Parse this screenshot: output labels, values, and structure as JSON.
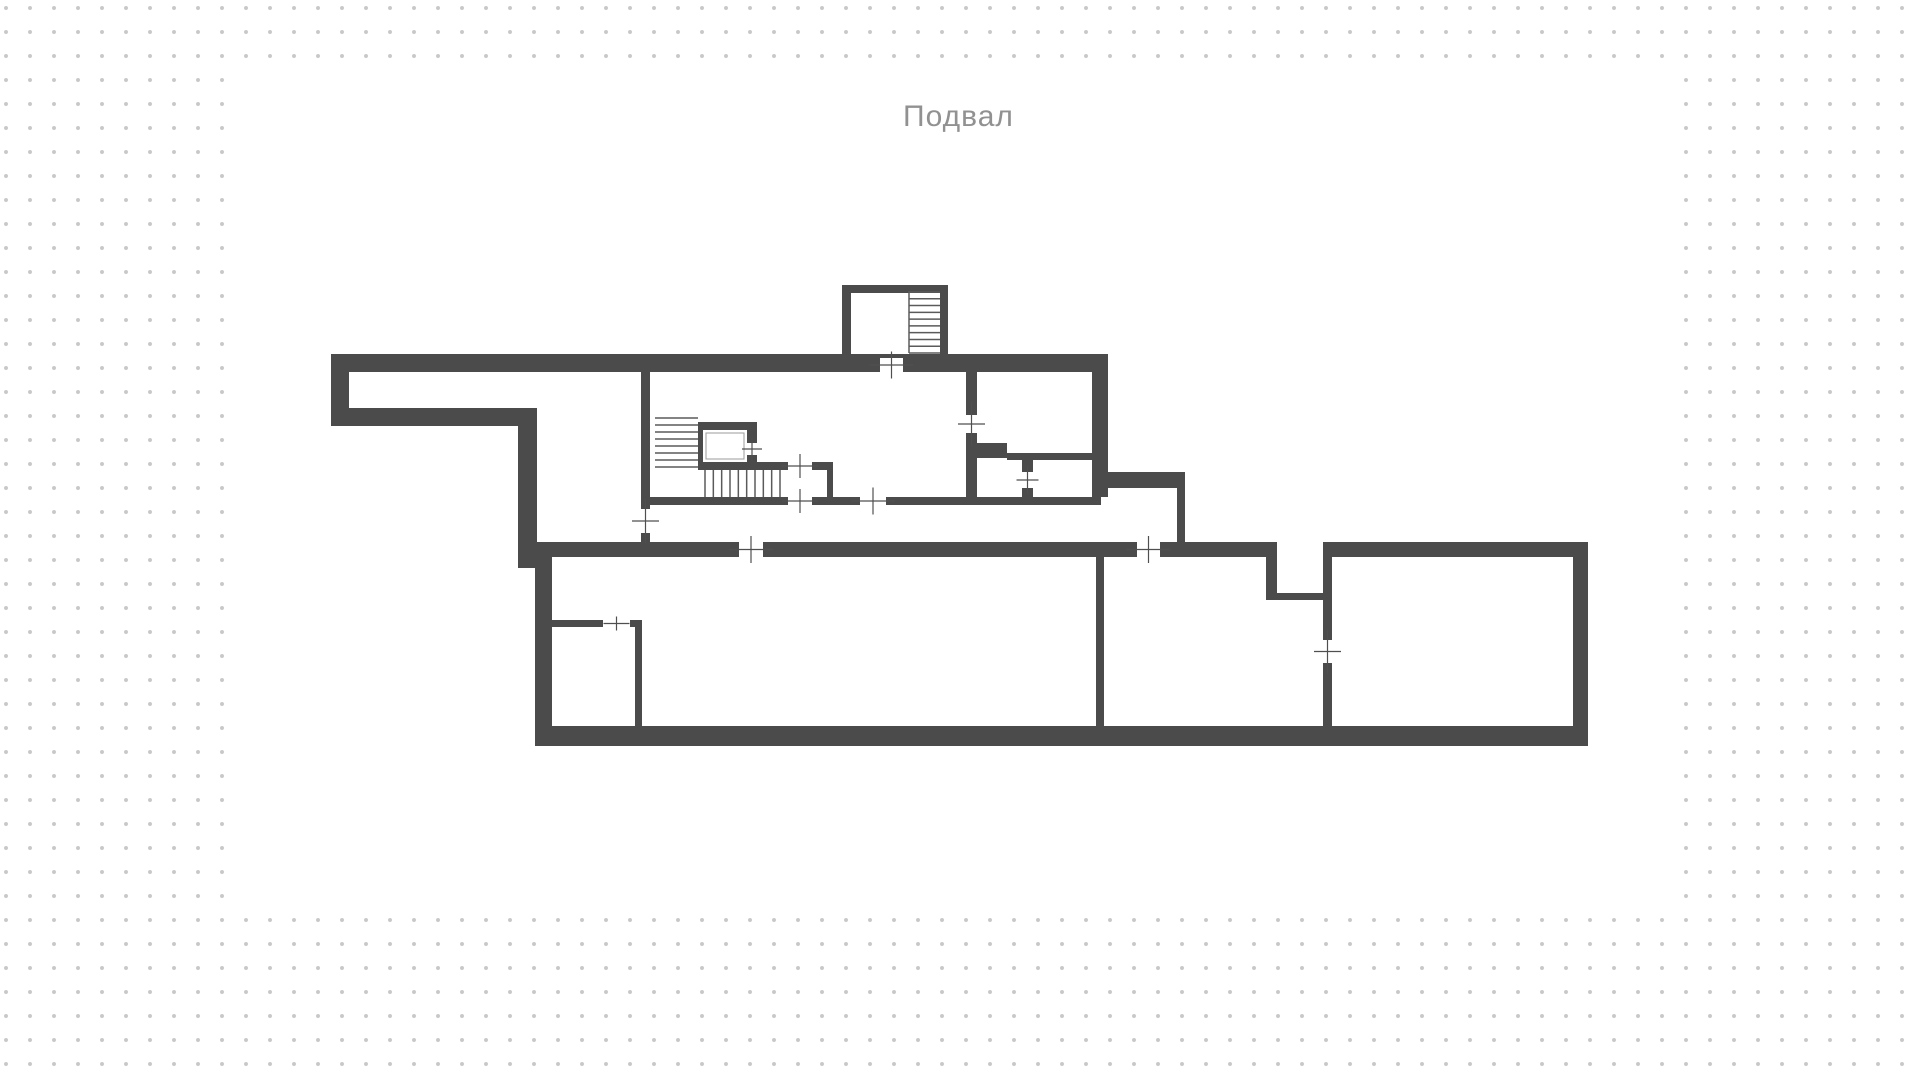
{
  "floorplan": {
    "title": "Подвал",
    "title_color": "#919191",
    "wall_color": "#4b4b4b",
    "tread_color": "#5a5a5a",
    "cross_color": "#4f4f4f",
    "dot_color": "#c8c8c8",
    "dot_spacing_px": 24,
    "canvas_rect": [
      233,
      66,
      1451,
      841
    ],
    "walls": [
      [
        331,
        354,
        777,
        18
      ],
      [
        331,
        354,
        18,
        72
      ],
      [
        331,
        408,
        206,
        18
      ],
      [
        518,
        408,
        19,
        160
      ],
      [
        641,
        372,
        9,
        137
      ],
      [
        641,
        533,
        9,
        9
      ],
      [
        842,
        285,
        9,
        69
      ],
      [
        842,
        285,
        106,
        8
      ],
      [
        940,
        285,
        8,
        69
      ],
      [
        966,
        372,
        11,
        43
      ],
      [
        966,
        433,
        11,
        64
      ],
      [
        970,
        443,
        37,
        15
      ],
      [
        1007,
        453,
        85,
        7
      ],
      [
        1022,
        460,
        11,
        12
      ],
      [
        1022,
        488,
        11,
        9
      ],
      [
        1092,
        354,
        16,
        143
      ],
      [
        1092,
        472,
        93,
        16
      ],
      [
        1177,
        488,
        8,
        54
      ],
      [
        698,
        462,
        90,
        8
      ],
      [
        812,
        462,
        21,
        8
      ],
      [
        827,
        462,
        6,
        43
      ],
      [
        642,
        497,
        146,
        8
      ],
      [
        812,
        497,
        48,
        8
      ],
      [
        886,
        497,
        215,
        8
      ],
      [
        535,
        542,
        204,
        15
      ],
      [
        763,
        542,
        374,
        15
      ],
      [
        1160,
        542,
        117,
        15
      ],
      [
        1323,
        542,
        265,
        15
      ],
      [
        535,
        557,
        17,
        189
      ],
      [
        535,
        726,
        1053,
        20
      ],
      [
        1573,
        542,
        15,
        204
      ],
      [
        1096,
        557,
        8,
        169
      ],
      [
        1266,
        557,
        11,
        43
      ],
      [
        1266,
        593,
        61,
        7
      ],
      [
        1323,
        557,
        9,
        83
      ],
      [
        1323,
        663,
        9,
        63
      ],
      [
        552,
        620,
        51,
        7
      ],
      [
        630,
        620,
        12,
        7
      ],
      [
        635,
        620,
        7,
        106
      ]
    ],
    "doors": [
      {
        "x": 880,
        "y": 358,
        "w": 23,
        "h": 14,
        "dir": "h"
      },
      {
        "x": 966,
        "y": 415,
        "w": 11,
        "h": 18,
        "dir": "v"
      },
      {
        "x": 747,
        "y": 443,
        "w": 10,
        "h": 12,
        "dir": "v",
        "long": 24,
        "short": 20
      },
      {
        "x": 788,
        "y": 462,
        "w": 24,
        "h": 8,
        "dir": "h",
        "long": 36,
        "short": 24
      },
      {
        "x": 788,
        "y": 497,
        "w": 24,
        "h": 8,
        "dir": "h",
        "long": 36,
        "short": 24
      },
      {
        "x": 860,
        "y": 497,
        "w": 26,
        "h": 8,
        "dir": "h"
      },
      {
        "x": 1022,
        "y": 472,
        "w": 11,
        "h": 16,
        "dir": "v",
        "long": 28,
        "short": 22
      },
      {
        "x": 641,
        "y": 509,
        "w": 9,
        "h": 24,
        "dir": "v"
      },
      {
        "x": 739,
        "y": 542,
        "w": 24,
        "h": 15,
        "dir": "h"
      },
      {
        "x": 1137,
        "y": 542,
        "w": 23,
        "h": 15,
        "dir": "h"
      },
      {
        "x": 603,
        "y": 620,
        "w": 27,
        "h": 7,
        "dir": "h",
        "long": 26,
        "short": 14
      },
      {
        "x": 1323,
        "y": 640,
        "w": 9,
        "h": 23,
        "dir": "v"
      }
    ],
    "stairs": [
      {
        "kind": "h",
        "x1": 909,
        "x2": 940,
        "a": 292,
        "b": 353,
        "n": 10
      },
      {
        "kind": "h",
        "x1": 655,
        "x2": 698,
        "a": 418,
        "b": 467,
        "n": 8
      },
      {
        "kind": "v",
        "y1": 470,
        "y2": 497,
        "a": 705,
        "b": 780,
        "n": 10
      }
    ],
    "stair_rails": [
      [
        909,
        291,
        909,
        353
      ]
    ],
    "elevator": {
      "outer": [
        698,
        422,
        59,
        40
      ],
      "inner": [
        703,
        430,
        44,
        32
      ],
      "cab_outline": [
        706,
        433,
        38,
        26
      ],
      "outline_color": "#9b9b9b"
    }
  }
}
